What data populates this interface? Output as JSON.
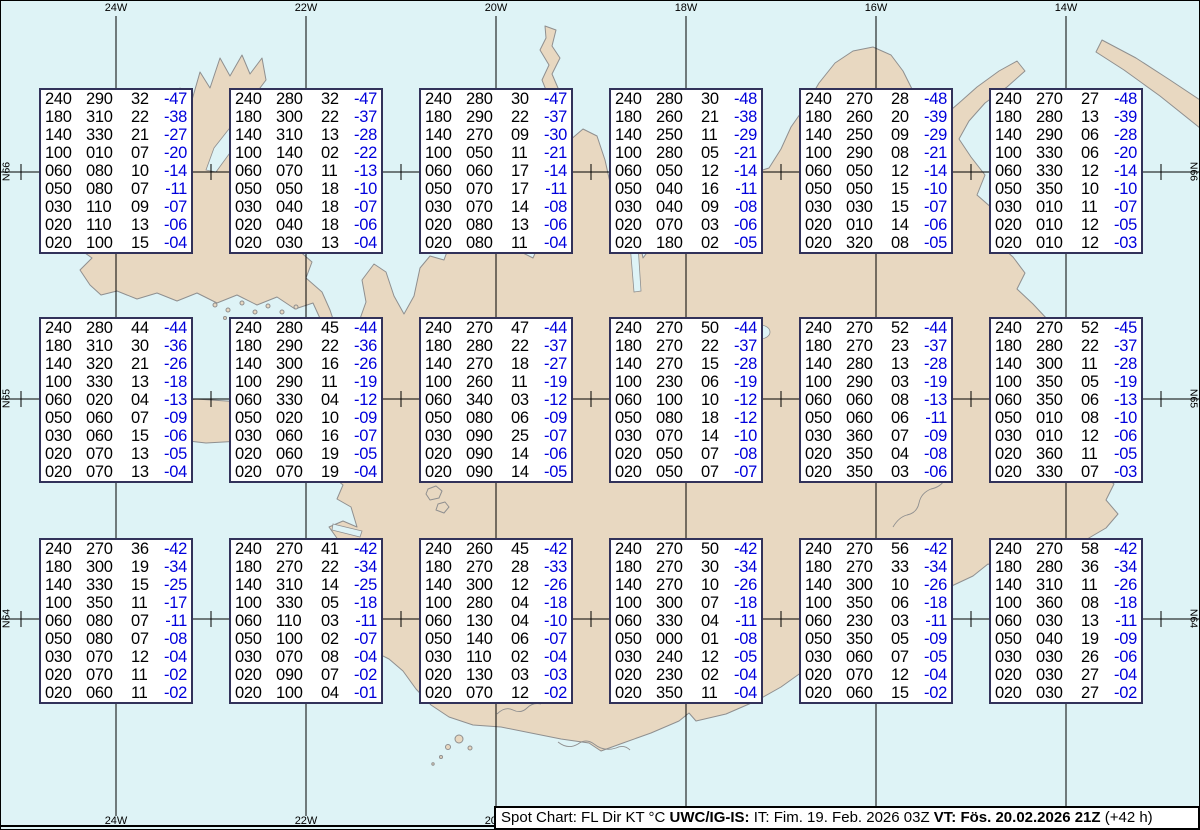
{
  "colors": {
    "water": "#def3f6",
    "land": "#e8d8c1",
    "coastline": "#8f8f8f",
    "grid": "#000000",
    "box_border": "#32325a",
    "temperature_blue": "#0000dd",
    "text_black": "#000000"
  },
  "graticule": {
    "meridians_x": [
      116,
      306,
      496,
      686,
      876,
      1066
    ],
    "parallels_y": [
      172,
      399,
      619
    ],
    "minor_tick_x": [
      21,
      211,
      401,
      591,
      781,
      971,
      1161
    ],
    "top_labels": [
      {
        "text": "24W",
        "x": 116
      },
      {
        "text": "22W",
        "x": 306
      },
      {
        "text": "20W",
        "x": 496
      },
      {
        "text": "18W",
        "x": 686
      },
      {
        "text": "16W",
        "x": 876
      },
      {
        "text": "14W",
        "x": 1066
      }
    ],
    "bottom_labels": [
      {
        "text": "24W",
        "x": 116
      },
      {
        "text": "22W",
        "x": 306
      },
      {
        "text": "20W",
        "x": 496
      },
      {
        "text": "18W",
        "x": 686
      },
      {
        "text": "16W",
        "x": 876
      },
      {
        "text": "14W",
        "x": 1066
      }
    ],
    "left_labels": [
      {
        "text": "N66",
        "y": 172
      },
      {
        "text": "N65",
        "y": 399
      },
      {
        "text": "N64",
        "y": 619
      }
    ],
    "right_labels": [
      {
        "text": "N66",
        "y": 172
      },
      {
        "text": "N65",
        "y": 399
      },
      {
        "text": "N64",
        "y": 619
      }
    ]
  },
  "spot_boxes": {
    "columns_x": [
      39,
      229,
      419,
      609,
      799,
      989
    ],
    "rows_y": [
      88,
      317,
      538
    ],
    "column_meaning": [
      "FL",
      "Dir",
      "KT",
      "°C"
    ],
    "cells": [
      [
        [
          "240",
          "290",
          "32",
          "-47"
        ],
        [
          "180",
          "310",
          "22",
          "-38"
        ],
        [
          "140",
          "330",
          "21",
          "-27"
        ],
        [
          "100",
          "010",
          "07",
          "-20"
        ],
        [
          "060",
          "080",
          "10",
          "-14"
        ],
        [
          "050",
          "080",
          "07",
          "-11"
        ],
        [
          "030",
          "110",
          "09",
          "-07"
        ],
        [
          "020",
          "110",
          "13",
          "-06"
        ],
        [
          "020",
          "100",
          "15",
          "-04"
        ]
      ],
      [
        [
          "240",
          "280",
          "32",
          "-47"
        ],
        [
          "180",
          "300",
          "22",
          "-37"
        ],
        [
          "140",
          "310",
          "13",
          "-28"
        ],
        [
          "100",
          "140",
          "02",
          "-22"
        ],
        [
          "060",
          "070",
          "11",
          "-13"
        ],
        [
          "050",
          "050",
          "18",
          "-10"
        ],
        [
          "030",
          "040",
          "18",
          "-07"
        ],
        [
          "020",
          "040",
          "18",
          "-06"
        ],
        [
          "020",
          "030",
          "13",
          "-04"
        ]
      ],
      [
        [
          "240",
          "280",
          "30",
          "-47"
        ],
        [
          "180",
          "290",
          "22",
          "-37"
        ],
        [
          "140",
          "270",
          "09",
          "-30"
        ],
        [
          "100",
          "050",
          "11",
          "-21"
        ],
        [
          "060",
          "060",
          "17",
          "-14"
        ],
        [
          "050",
          "070",
          "17",
          "-11"
        ],
        [
          "030",
          "070",
          "14",
          "-08"
        ],
        [
          "020",
          "080",
          "13",
          "-06"
        ],
        [
          "020",
          "080",
          "11",
          "-04"
        ]
      ],
      [
        [
          "240",
          "280",
          "30",
          "-48"
        ],
        [
          "180",
          "260",
          "21",
          "-38"
        ],
        [
          "140",
          "250",
          "11",
          "-29"
        ],
        [
          "100",
          "280",
          "05",
          "-21"
        ],
        [
          "060",
          "050",
          "12",
          "-14"
        ],
        [
          "050",
          "040",
          "16",
          "-11"
        ],
        [
          "030",
          "040",
          "09",
          "-08"
        ],
        [
          "020",
          "070",
          "03",
          "-06"
        ],
        [
          "020",
          "180",
          "02",
          "-05"
        ]
      ],
      [
        [
          "240",
          "270",
          "28",
          "-48"
        ],
        [
          "180",
          "260",
          "20",
          "-39"
        ],
        [
          "140",
          "250",
          "09",
          "-29"
        ],
        [
          "100",
          "290",
          "08",
          "-21"
        ],
        [
          "060",
          "050",
          "12",
          "-14"
        ],
        [
          "050",
          "050",
          "15",
          "-10"
        ],
        [
          "030",
          "030",
          "15",
          "-07"
        ],
        [
          "020",
          "010",
          "14",
          "-06"
        ],
        [
          "020",
          "320",
          "08",
          "-05"
        ]
      ],
      [
        [
          "240",
          "270",
          "27",
          "-48"
        ],
        [
          "180",
          "280",
          "13",
          "-39"
        ],
        [
          "140",
          "290",
          "06",
          "-28"
        ],
        [
          "100",
          "330",
          "06",
          "-20"
        ],
        [
          "060",
          "330",
          "12",
          "-14"
        ],
        [
          "050",
          "350",
          "10",
          "-10"
        ],
        [
          "030",
          "010",
          "11",
          "-07"
        ],
        [
          "020",
          "010",
          "12",
          "-05"
        ],
        [
          "020",
          "010",
          "12",
          "-03"
        ]
      ],
      [
        [
          "240",
          "280",
          "44",
          "-44"
        ],
        [
          "180",
          "310",
          "30",
          "-36"
        ],
        [
          "140",
          "320",
          "21",
          "-26"
        ],
        [
          "100",
          "330",
          "13",
          "-18"
        ],
        [
          "060",
          "020",
          "04",
          "-13"
        ],
        [
          "050",
          "060",
          "07",
          "-09"
        ],
        [
          "030",
          "060",
          "15",
          "-06"
        ],
        [
          "020",
          "070",
          "13",
          "-05"
        ],
        [
          "020",
          "070",
          "13",
          "-04"
        ]
      ],
      [
        [
          "240",
          "280",
          "45",
          "-44"
        ],
        [
          "180",
          "290",
          "22",
          "-36"
        ],
        [
          "140",
          "300",
          "16",
          "-26"
        ],
        [
          "100",
          "290",
          "11",
          "-19"
        ],
        [
          "060",
          "330",
          "04",
          "-12"
        ],
        [
          "050",
          "020",
          "10",
          "-09"
        ],
        [
          "030",
          "060",
          "16",
          "-07"
        ],
        [
          "020",
          "060",
          "19",
          "-05"
        ],
        [
          "020",
          "070",
          "19",
          "-04"
        ]
      ],
      [
        [
          "240",
          "270",
          "47",
          "-44"
        ],
        [
          "180",
          "280",
          "22",
          "-37"
        ],
        [
          "140",
          "270",
          "18",
          "-27"
        ],
        [
          "100",
          "260",
          "11",
          "-19"
        ],
        [
          "060",
          "340",
          "03",
          "-12"
        ],
        [
          "050",
          "080",
          "06",
          "-09"
        ],
        [
          "030",
          "090",
          "25",
          "-07"
        ],
        [
          "020",
          "090",
          "14",
          "-06"
        ],
        [
          "020",
          "090",
          "14",
          "-05"
        ]
      ],
      [
        [
          "240",
          "270",
          "50",
          "-44"
        ],
        [
          "180",
          "270",
          "22",
          "-37"
        ],
        [
          "140",
          "270",
          "15",
          "-28"
        ],
        [
          "100",
          "230",
          "06",
          "-19"
        ],
        [
          "060",
          "100",
          "10",
          "-12"
        ],
        [
          "050",
          "080",
          "18",
          "-12"
        ],
        [
          "030",
          "070",
          "14",
          "-10"
        ],
        [
          "020",
          "050",
          "07",
          "-08"
        ],
        [
          "020",
          "050",
          "07",
          "-07"
        ]
      ],
      [
        [
          "240",
          "270",
          "52",
          "-44"
        ],
        [
          "180",
          "270",
          "23",
          "-37"
        ],
        [
          "140",
          "280",
          "13",
          "-28"
        ],
        [
          "100",
          "290",
          "03",
          "-19"
        ],
        [
          "060",
          "060",
          "08",
          "-13"
        ],
        [
          "050",
          "060",
          "06",
          "-11"
        ],
        [
          "030",
          "360",
          "07",
          "-09"
        ],
        [
          "020",
          "350",
          "04",
          "-08"
        ],
        [
          "020",
          "350",
          "03",
          "-06"
        ]
      ],
      [
        [
          "240",
          "270",
          "52",
          "-45"
        ],
        [
          "180",
          "280",
          "22",
          "-37"
        ],
        [
          "140",
          "300",
          "11",
          "-28"
        ],
        [
          "100",
          "350",
          "05",
          "-19"
        ],
        [
          "060",
          "350",
          "06",
          "-13"
        ],
        [
          "050",
          "010",
          "08",
          "-10"
        ],
        [
          "030",
          "010",
          "12",
          "-06"
        ],
        [
          "020",
          "360",
          "11",
          "-05"
        ],
        [
          "020",
          "330",
          "07",
          "-03"
        ]
      ],
      [
        [
          "240",
          "270",
          "36",
          "-42"
        ],
        [
          "180",
          "300",
          "19",
          "-34"
        ],
        [
          "140",
          "330",
          "15",
          "-25"
        ],
        [
          "100",
          "350",
          "11",
          "-17"
        ],
        [
          "060",
          "080",
          "07",
          "-11"
        ],
        [
          "050",
          "080",
          "07",
          "-08"
        ],
        [
          "030",
          "070",
          "12",
          "-04"
        ],
        [
          "020",
          "070",
          "11",
          "-02"
        ],
        [
          "020",
          "060",
          "11",
          "-02"
        ]
      ],
      [
        [
          "240",
          "270",
          "41",
          "-42"
        ],
        [
          "180",
          "270",
          "22",
          "-34"
        ],
        [
          "140",
          "310",
          "14",
          "-25"
        ],
        [
          "100",
          "330",
          "05",
          "-18"
        ],
        [
          "060",
          "110",
          "03",
          "-11"
        ],
        [
          "050",
          "100",
          "02",
          "-07"
        ],
        [
          "030",
          "070",
          "08",
          "-04"
        ],
        [
          "020",
          "090",
          "07",
          "-02"
        ],
        [
          "020",
          "100",
          "04",
          "-01"
        ]
      ],
      [
        [
          "240",
          "260",
          "45",
          "-42"
        ],
        [
          "180",
          "270",
          "28",
          "-33"
        ],
        [
          "140",
          "300",
          "12",
          "-26"
        ],
        [
          "100",
          "280",
          "04",
          "-18"
        ],
        [
          "060",
          "130",
          "04",
          "-10"
        ],
        [
          "050",
          "140",
          "06",
          "-07"
        ],
        [
          "030",
          "110",
          "02",
          "-04"
        ],
        [
          "020",
          "130",
          "03",
          "-03"
        ],
        [
          "020",
          "070",
          "12",
          "-02"
        ]
      ],
      [
        [
          "240",
          "270",
          "50",
          "-42"
        ],
        [
          "180",
          "270",
          "30",
          "-34"
        ],
        [
          "140",
          "270",
          "10",
          "-26"
        ],
        [
          "100",
          "300",
          "07",
          "-18"
        ],
        [
          "060",
          "330",
          "04",
          "-11"
        ],
        [
          "050",
          "000",
          "01",
          "-08"
        ],
        [
          "030",
          "240",
          "12",
          "-05"
        ],
        [
          "020",
          "230",
          "02",
          "-04"
        ],
        [
          "020",
          "350",
          "11",
          "-04"
        ]
      ],
      [
        [
          "240",
          "270",
          "56",
          "-42"
        ],
        [
          "180",
          "270",
          "33",
          "-34"
        ],
        [
          "140",
          "300",
          "10",
          "-26"
        ],
        [
          "100",
          "350",
          "06",
          "-18"
        ],
        [
          "060",
          "230",
          "03",
          "-11"
        ],
        [
          "050",
          "350",
          "05",
          "-09"
        ],
        [
          "030",
          "060",
          "07",
          "-05"
        ],
        [
          "020",
          "070",
          "12",
          "-04"
        ],
        [
          "020",
          "060",
          "15",
          "-02"
        ]
      ],
      [
        [
          "240",
          "270",
          "58",
          "-42"
        ],
        [
          "180",
          "280",
          "36",
          "-34"
        ],
        [
          "140",
          "310",
          "11",
          "-26"
        ],
        [
          "100",
          "360",
          "08",
          "-18"
        ],
        [
          "060",
          "030",
          "13",
          "-11"
        ],
        [
          "050",
          "040",
          "19",
          "-09"
        ],
        [
          "030",
          "030",
          "26",
          "-06"
        ],
        [
          "020",
          "030",
          "27",
          "-04"
        ],
        [
          "020",
          "030",
          "27",
          "-02"
        ]
      ]
    ]
  },
  "status_bar": {
    "segments": [
      {
        "text": "Spot Chart: FL Dir KT °C ",
        "bold": false
      },
      {
        "text": "UWC/IG-IS:",
        "bold": true
      },
      {
        "text": " IT: Fim. 19. Feb. 2026 03Z ",
        "bold": false
      },
      {
        "text": "VT: Fös. 20.02.2026 21Z",
        "bold": true
      },
      {
        "text": " (+42 h)",
        "bold": false
      }
    ]
  }
}
